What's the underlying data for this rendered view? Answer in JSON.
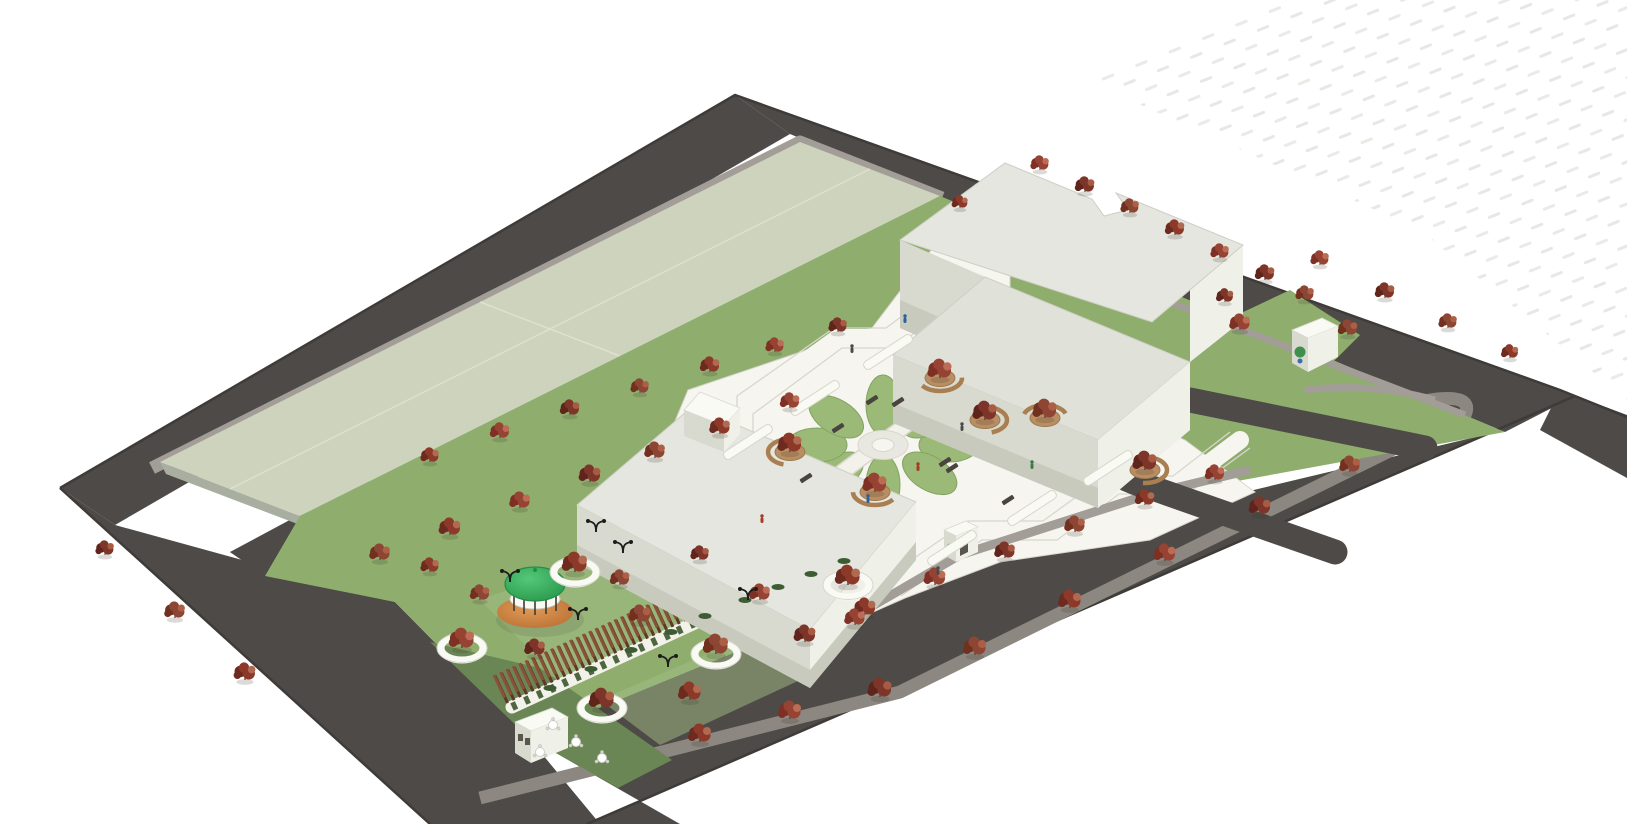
{
  "scene": {
    "type": "3d-architectural-site-plan-rendering",
    "view": "axonometric aerial view, no visible text"
  },
  "colors": {
    "bg": "#ffffff",
    "dash": "#e9e7e4",
    "road": "#4e4a47",
    "roadEdge": "#3e3b38",
    "median": "#8c8780",
    "walkGray": "#a29d96",
    "field": "#ced3bd",
    "fieldSideA": "#b7bda9",
    "fieldSideB": "#a8aea0",
    "fieldLine": "#dde1cf",
    "lawn": "#8fae6e",
    "lawnLight": "#a3bd85",
    "plaza": "#f6f5f0",
    "plazaLine": "#d8d6cd",
    "petal": "#9cba77",
    "petalEdge": "#82a362",
    "flowerCenter": "#e9e8e0",
    "roofA": "#e4e6df",
    "roofB": "#e0e2d9",
    "roofEdge": "#cdd0c4",
    "wallShade": "#d8dacf",
    "wallLight": "#eff0e8",
    "wallDark": "#c7cabd",
    "white": "#fafaf5",
    "pergolaTop": "#8a5139",
    "pergolaDark": "#5e3826",
    "arcadeWall": "#f2f1ea",
    "arch": "#4e663f",
    "hedge": "#3e5c33",
    "domeEdge": "#248b45",
    "planter": "#b98e63",
    "planterEdge": "#9c7a50",
    "benchWood": "#a97f52",
    "benchDark": "#4a4440",
    "lamp": "#1c1c1c",
    "ring": "#fafaf5",
    "trunk": "#5a4a3f",
    "treeShadow": "rgba(60,50,40,0.18)"
  },
  "tree_palette": [
    [
      "#6d2a1f",
      "#8d392a",
      "#b06a52"
    ],
    [
      "#7e3024",
      "#964334",
      "#bc6b55"
    ],
    [
      "#5f241b",
      "#7e3529",
      "#a85a43"
    ],
    [
      "#72301f",
      "#8d4634",
      "#ad5f45"
    ]
  ],
  "people_palette": [
    "#4a4a4a",
    "#a33b2a",
    "#2c5f9e",
    "#3e7a46"
  ],
  "planting": {
    "trees": [
      [
        430,
        462,
        0.8
      ],
      [
        500,
        438,
        0.85
      ],
      [
        570,
        415,
        0.85
      ],
      [
        640,
        393,
        0.8
      ],
      [
        710,
        372,
        0.85
      ],
      [
        775,
        352,
        0.8
      ],
      [
        838,
        332,
        0.8
      ],
      [
        380,
        560,
        0.9
      ],
      [
        450,
        535,
        0.95
      ],
      [
        520,
        508,
        0.9
      ],
      [
        590,
        482,
        0.95
      ],
      [
        655,
        458,
        0.9
      ],
      [
        720,
        434,
        0.9
      ],
      [
        790,
        408,
        0.85
      ],
      [
        105,
        555,
        0.8
      ],
      [
        175,
        618,
        0.9
      ],
      [
        245,
        680,
        0.95
      ],
      [
        1040,
        170,
        0.8
      ],
      [
        1085,
        192,
        0.85
      ],
      [
        1130,
        213,
        0.8
      ],
      [
        1175,
        235,
        0.85
      ],
      [
        1220,
        258,
        0.8
      ],
      [
        1265,
        280,
        0.85
      ],
      [
        1305,
        300,
        0.8
      ],
      [
        960,
        208,
        0.7
      ],
      [
        1320,
        265,
        0.8
      ],
      [
        1385,
        298,
        0.85
      ],
      [
        1448,
        328,
        0.8
      ],
      [
        1510,
        358,
        0.75
      ],
      [
        1240,
        330,
        0.9
      ],
      [
        1225,
        302,
        0.75
      ],
      [
        1348,
        335,
        0.85
      ],
      [
        700,
        742,
        1.0
      ],
      [
        790,
        719,
        1.0
      ],
      [
        880,
        697,
        1.05
      ],
      [
        975,
        655,
        1.0
      ],
      [
        1070,
        608,
        1.0
      ],
      [
        1165,
        561,
        0.95
      ],
      [
        1260,
        514,
        0.95
      ],
      [
        1350,
        472,
        0.9
      ],
      [
        865,
        615,
        0.95
      ],
      [
        935,
        585,
        0.95
      ],
      [
        1005,
        558,
        0.9
      ],
      [
        1075,
        532,
        0.9
      ],
      [
        1145,
        505,
        0.85
      ],
      [
        1215,
        480,
        0.85
      ],
      [
        535,
        655,
        0.9
      ],
      [
        640,
        622,
        0.95
      ],
      [
        690,
        700,
        1.0
      ],
      [
        760,
        600,
        0.9
      ],
      [
        805,
        642,
        0.95
      ],
      [
        480,
        600,
        0.85
      ],
      [
        430,
        572,
        0.8
      ],
      [
        855,
        625,
        0.9
      ],
      [
        700,
        560,
        0.8
      ],
      [
        620,
        585,
        0.85
      ]
    ],
    "rings": [
      [
        575,
        572
      ],
      [
        462,
        648
      ],
      [
        602,
        708
      ],
      [
        716,
        654
      ],
      [
        848,
        585
      ]
    ],
    "planter_trees": [
      [
        940,
        378
      ],
      [
        985,
        420
      ],
      [
        1045,
        418
      ],
      [
        790,
        452
      ],
      [
        875,
        492
      ],
      [
        1145,
        470
      ]
    ],
    "hedges": [
      [
        550,
        688
      ],
      [
        591,
        669
      ],
      [
        631,
        650
      ],
      [
        671,
        632
      ],
      [
        705,
        616
      ],
      [
        745,
        600
      ],
      [
        778,
        587
      ],
      [
        811,
        574
      ],
      [
        844,
        561
      ]
    ]
  },
  "furniture": {
    "lamps": [
      [
        596,
        532
      ],
      [
        623,
        553
      ],
      [
        510,
        582
      ],
      [
        578,
        620
      ],
      [
        668,
        667
      ],
      [
        748,
        600
      ]
    ],
    "tables": [
      [
        553,
        725
      ],
      [
        576,
        742
      ],
      [
        540,
        752
      ],
      [
        602,
        758
      ]
    ],
    "benches": [
      [
        806,
        478
      ],
      [
        952,
        468
      ],
      [
        872,
        400
      ],
      [
        1008,
        500
      ],
      [
        838,
        428
      ],
      [
        945,
        462
      ],
      [
        882,
        486
      ],
      [
        898,
        402
      ]
    ],
    "planter_bars": [
      [
        748,
        442
      ],
      [
        815,
        398
      ],
      [
        888,
        352
      ],
      [
        952,
        548
      ],
      [
        1032,
        508
      ],
      [
        1108,
        468
      ]
    ]
  },
  "people": [
    [
      852,
      352,
      0
    ],
    [
      918,
      470,
      1
    ],
    [
      868,
      502,
      2
    ],
    [
      962,
      430,
      0
    ],
    [
      1032,
      468,
      3
    ],
    [
      762,
      522,
      1
    ],
    [
      905,
      322,
      2
    ],
    [
      938,
      574,
      0
    ]
  ],
  "flower": {
    "cx": 883,
    "cy": 445,
    "petals": 8,
    "orbit_rx": 66,
    "orbit_ry": 40,
    "petal_rx": 30,
    "petal_ry": 17
  }
}
